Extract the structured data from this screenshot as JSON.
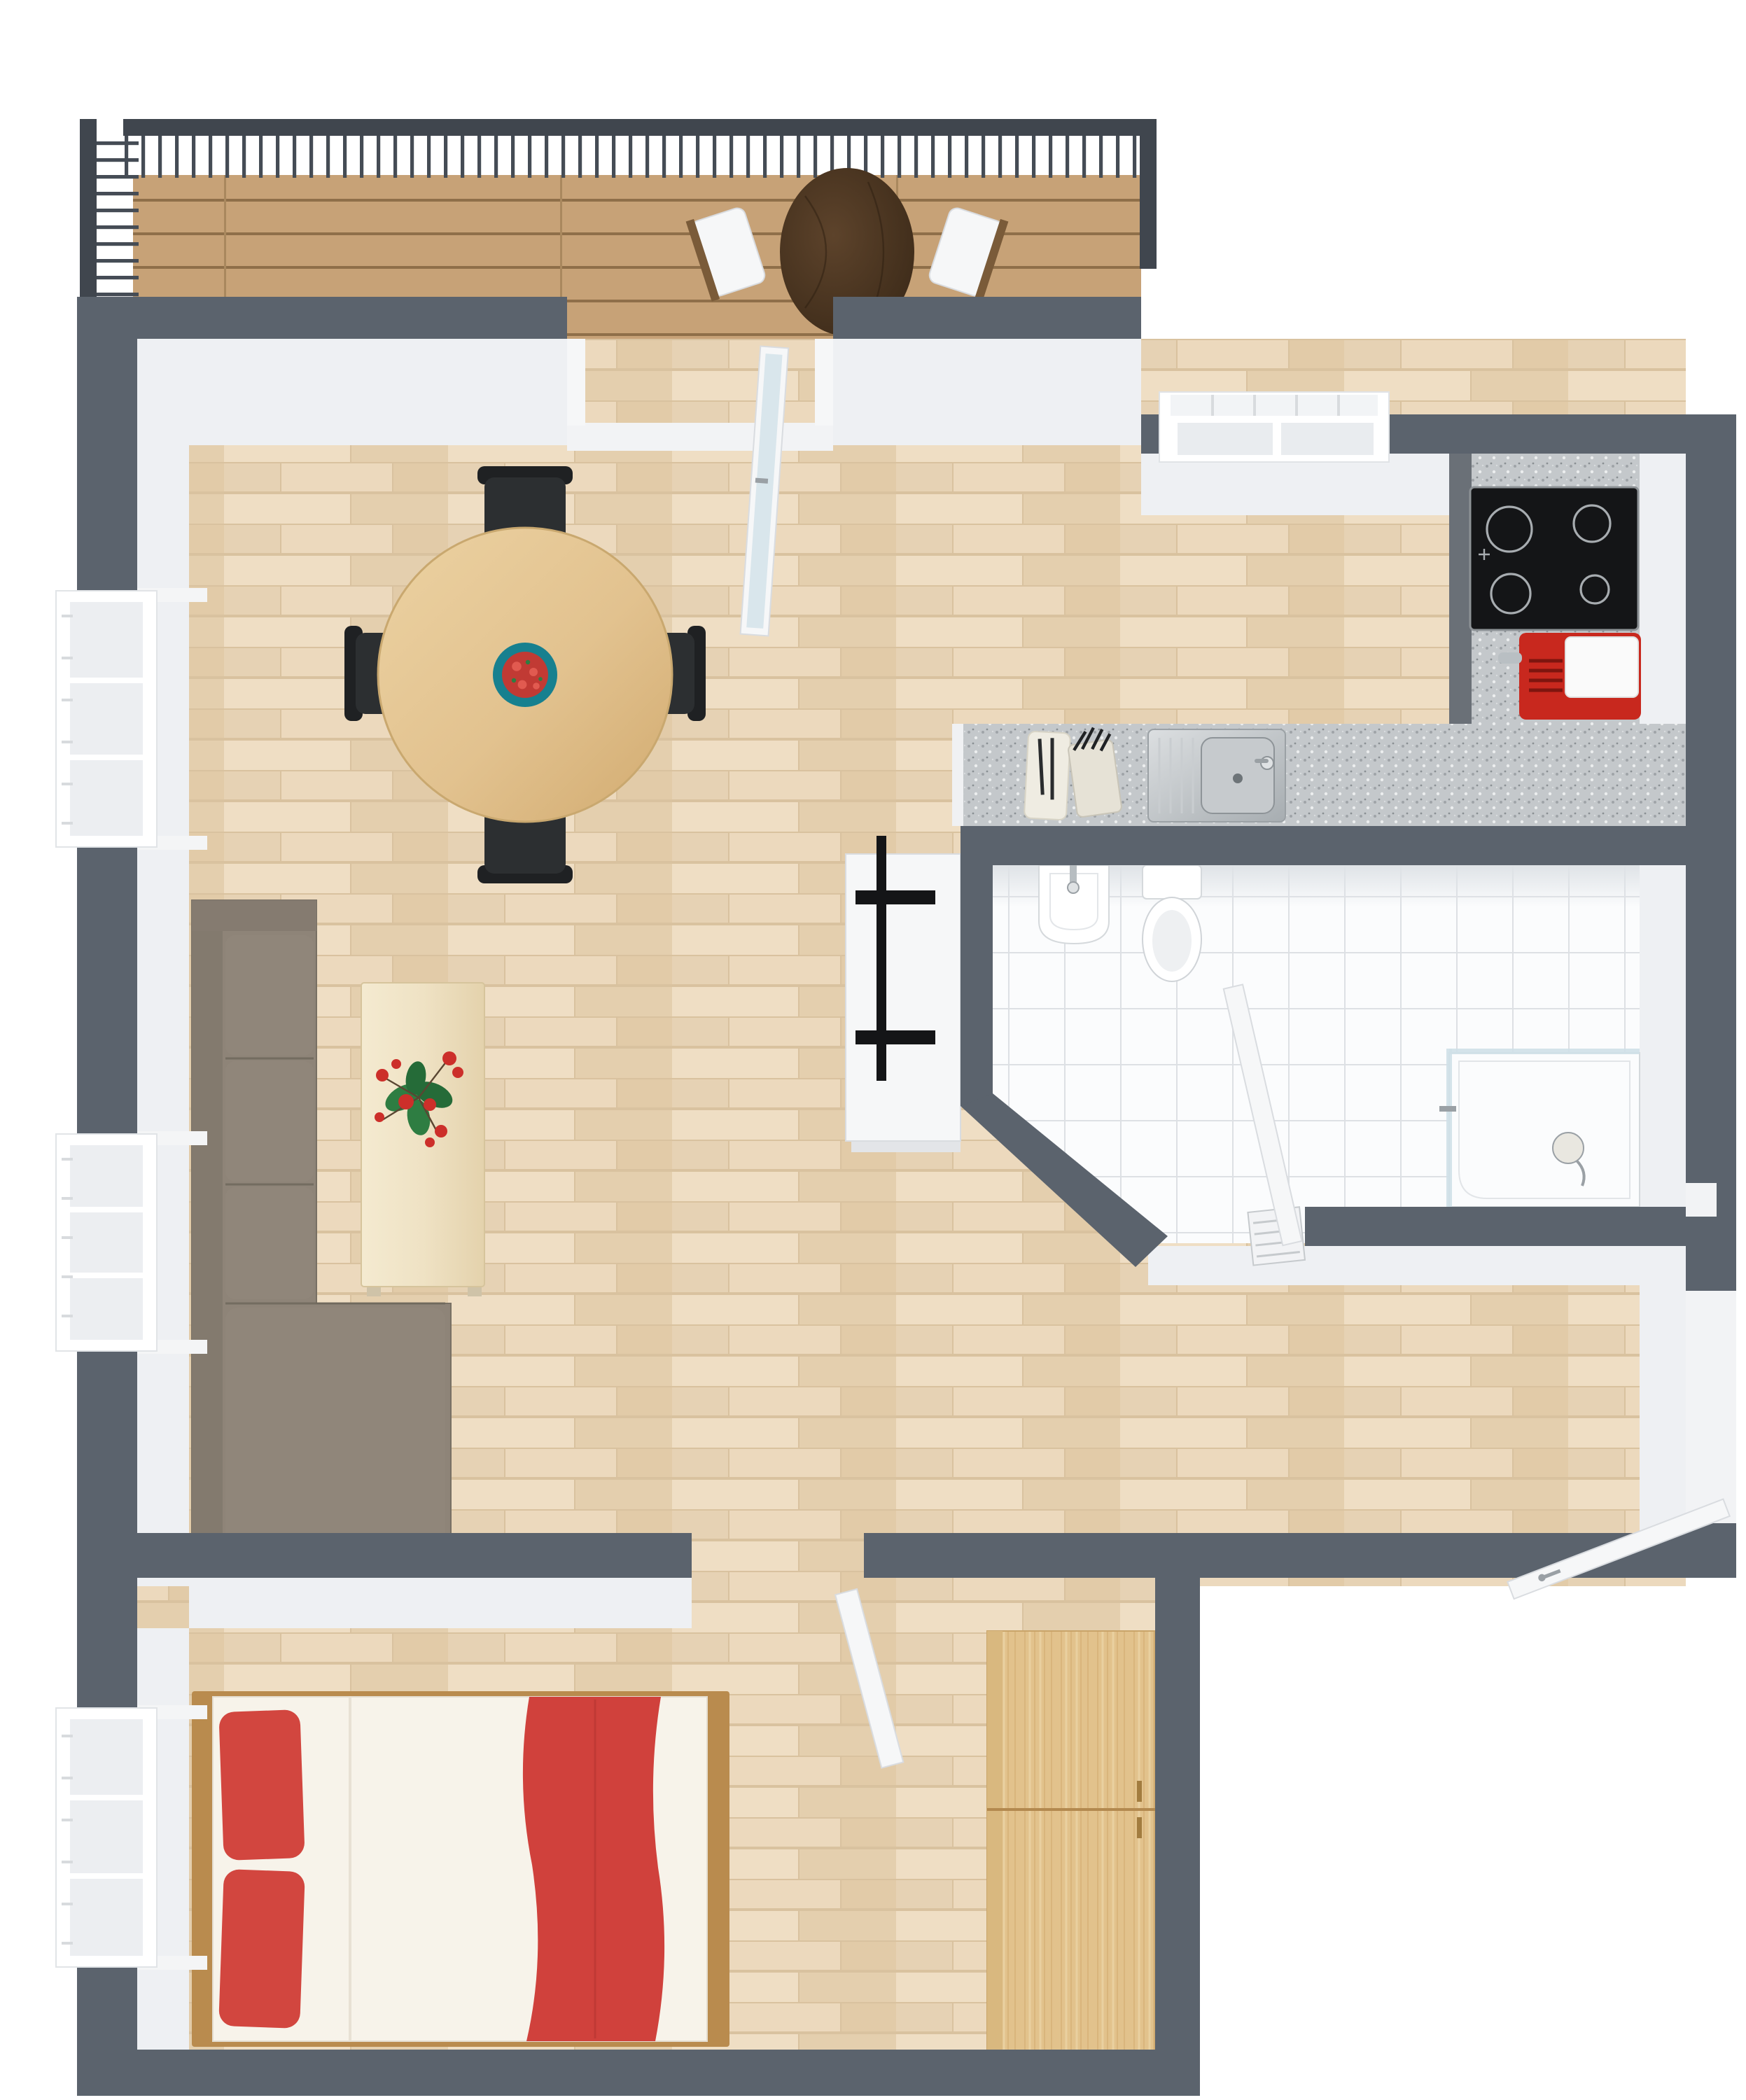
{
  "meta": {
    "title": "Top-down 3D floor plan render - one-bedroom apartment with balcony",
    "view": "bird's-eye 3D render",
    "visible_text": "none"
  },
  "colors": {
    "wall": "#5b636d",
    "wallFace": "#eef0f3",
    "rail": "#40464e",
    "floor": "#e9d6ba",
    "deck": "#c7a277",
    "sofa": "#8e8478",
    "cushion": "#90867a",
    "beech": "#e2c28f",
    "oak": "#e2c28c",
    "red": "#d2463f",
    "teal": "#17808f",
    "black": "#141517",
    "steel": "#b9bfc3",
    "glass": "#cfe0e8",
    "white": "#f6f7f8"
  },
  "rooms": [
    {
      "name": "balcony",
      "position": "top",
      "floor": "wood decking",
      "furniture": [
        "railing with vertical balusters",
        "round dark-wood bistro table",
        "2 white chairs"
      ]
    },
    {
      "name": "living-dining room",
      "position": "left/center",
      "floor": "light parquet",
      "furniture": [
        "round beech dining table",
        "4 black dining chairs",
        "teal bowl with strawberries",
        "taupe L-shaped sectional sofa",
        "long pale-wood coffee table with red flower",
        "white TV sideboard with flat TV"
      ],
      "windows": 2,
      "doors": [
        "glass balcony door (open)"
      ]
    },
    {
      "name": "kitchen",
      "position": "top-right",
      "floor": "light parquet",
      "furniture": [
        "granite counter with stainless sink",
        "cutting board with knives",
        "knife block",
        "black 4-burner cooktop",
        "red appliance with white canister"
      ],
      "windows": 1
    },
    {
      "name": "bathroom",
      "position": "middle-right",
      "floor": "white tile",
      "shape": "angled corner wall",
      "furniture": [
        "wall-hung wash basin",
        "toilet with cistern plate",
        "corner shower with glass panels and hand shower",
        "small radiator"
      ],
      "doors": [
        "white door (open into bathroom)"
      ]
    },
    {
      "name": "hallway",
      "position": "right of bedroom, below bathroom",
      "floor": "light parquet",
      "doors": [
        "white entry door (open, angled)"
      ]
    },
    {
      "name": "bedroom",
      "position": "bottom-left",
      "floor": "light parquet",
      "furniture": [
        "double bed with wood frame",
        "2 red pillows",
        "red runner blanket",
        "two-door oak wardrobe"
      ],
      "windows": 1,
      "doors": [
        "white door (open from living room)"
      ]
    }
  ],
  "counts": {
    "dining_chairs": 4,
    "balcony_chairs": 2,
    "cooktop_burners": 4,
    "windows_total": 4,
    "open_doors": 5
  }
}
